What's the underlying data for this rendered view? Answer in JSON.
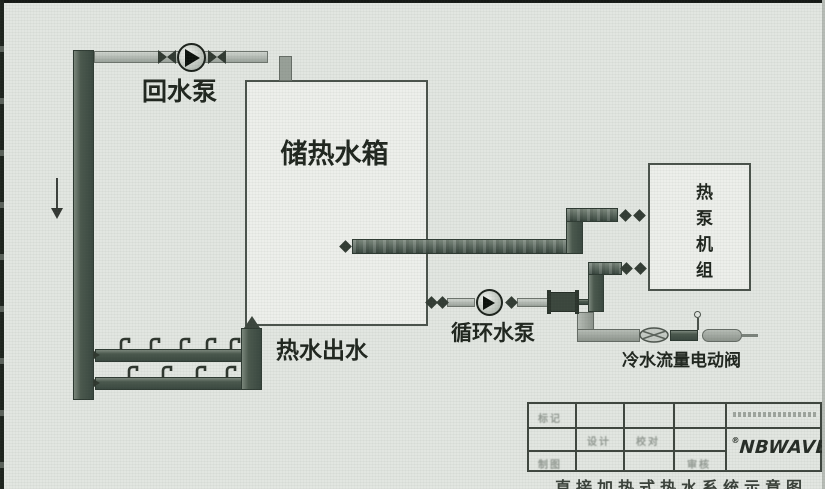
{
  "diagram": {
    "return_pump_label": "回水泵",
    "tank_label": "储热水箱",
    "hot_outlet_label": "热水出水",
    "circulation_pump_label": "循环水泵",
    "heat_pump_label": "热泵机组",
    "cold_valve_label": "冷水流量电动阀"
  },
  "title_block": {
    "logo_text": "NBWAVE",
    "logo_mark": "®",
    "drawing_title": "直接加热式热水系统示意图",
    "fields": {
      "mark": "标记",
      "design": "设计",
      "check": "校对",
      "draft": "制图",
      "review": "审核"
    }
  }
}
